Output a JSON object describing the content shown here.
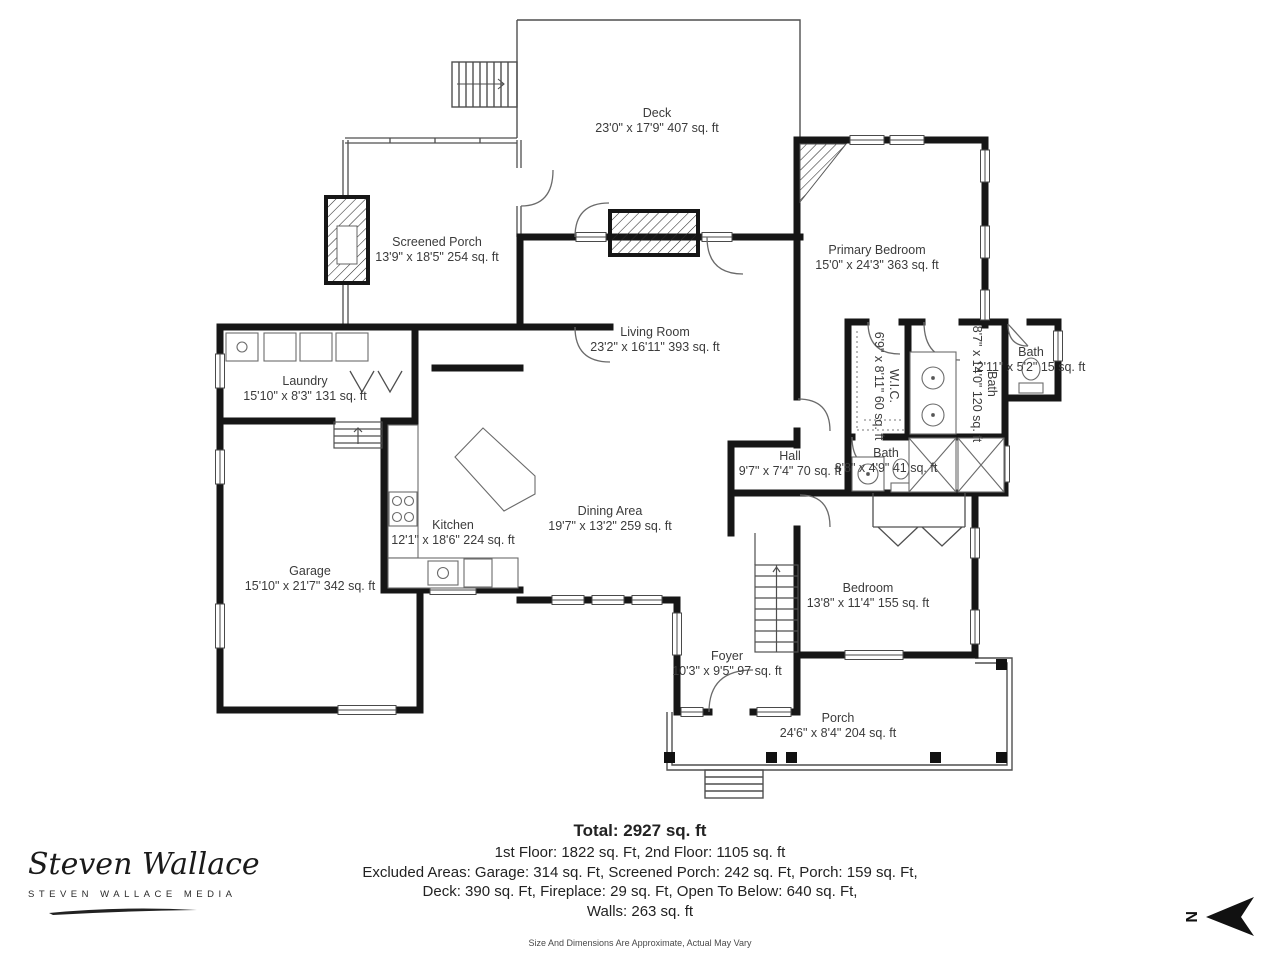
{
  "rooms": [
    {
      "id": "deck",
      "name": "Deck",
      "dims": "23'0\" x 17'9\" 407 sq. ft"
    },
    {
      "id": "screened-porch",
      "name": "Screened Porch",
      "dims": "13'9\" x 18'5\" 254 sq. ft"
    },
    {
      "id": "primary-bedroom",
      "name": "Primary Bedroom",
      "dims": "15'0\" x 24'3\" 363 sq. ft"
    },
    {
      "id": "living-room",
      "name": "Living Room",
      "dims": "23'2\" x 16'11\" 393 sq. ft"
    },
    {
      "id": "laundry",
      "name": "Laundry",
      "dims": "15'10\" x 8'3\" 131 sq. ft"
    },
    {
      "id": "wic",
      "name": "W.I.C.",
      "dims": "6'9\" x 8'11\" 60 sq. ft"
    },
    {
      "id": "primary-bath",
      "name": "Bath",
      "dims": "8'7\" x 14'0\" 120 sq. ft"
    },
    {
      "id": "small-bath",
      "name": "Bath",
      "dims": "2'11\" x 5'2\" 15 sq. ft"
    },
    {
      "id": "hall-bath",
      "name": "Bath",
      "dims": "8'8\" x 4'9\" 41 sq. ft"
    },
    {
      "id": "hall",
      "name": "Hall",
      "dims": "9'7\" x 7'4\" 70 sq. ft"
    },
    {
      "id": "kitchen",
      "name": "Kitchen",
      "dims": "12'1\" x 18'6\" 224 sq. ft"
    },
    {
      "id": "dining-area",
      "name": "Dining Area",
      "dims": "19'7\" x 13'2\" 259 sq. ft"
    },
    {
      "id": "garage",
      "name": "Garage",
      "dims": "15'10\" x 21'7\" 342 sq. ft"
    },
    {
      "id": "bedroom",
      "name": "Bedroom",
      "dims": "13'8\" x 11'4\" 155 sq. ft"
    },
    {
      "id": "foyer",
      "name": "Foyer",
      "dims": "10'3\" x 9'5\" 97 sq. ft"
    },
    {
      "id": "porch",
      "name": "Porch",
      "dims": "24'6\" x 8'4\" 204 sq. ft"
    }
  ],
  "summary": {
    "total": "Total: 2927 sq. ft",
    "floors": "1st Floor: 1822 sq. Ft, 2nd Floor: 1105 sq. ft",
    "excluded1": "Excluded Areas: Garage: 314 sq. Ft, Screened Porch: 242 sq. Ft, Porch: 159 sq. Ft,",
    "excluded2": "Deck: 390 sq. Ft, Fireplace: 29 sq. Ft, Open To Below: 640 sq. Ft,",
    "walls": "Walls: 263 sq. ft",
    "disclaimer": "Size And Dimensions Are Approximate, Actual May Vary"
  },
  "branding": {
    "script_name": "Steven Wallace",
    "subtitle": "STEVEN WALLACE MEDIA"
  },
  "compass": {
    "label": "N"
  },
  "colors": {
    "wall": "#161616",
    "thin_line": "#4f4f4f",
    "label_text": "#3b3b3b"
  }
}
